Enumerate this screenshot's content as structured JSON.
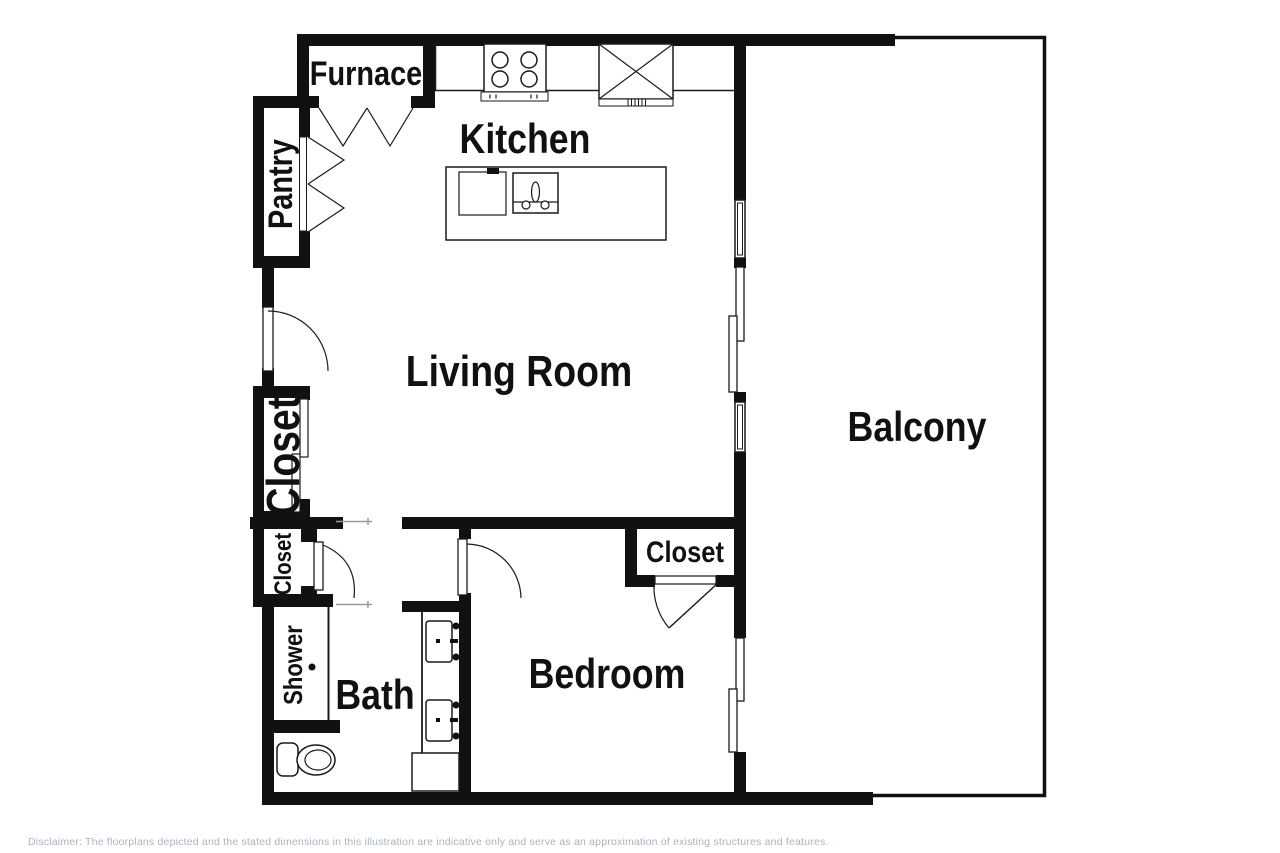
{
  "floorplan": {
    "rooms": {
      "furnace": {
        "label": "Furnace"
      },
      "kitchen": {
        "label": "Kitchen"
      },
      "pantry": {
        "label": "Pantry"
      },
      "living_room": {
        "label": "Living Room"
      },
      "closet_hall_large": {
        "label": "Closet"
      },
      "closet_hall_small": {
        "label": "Closet"
      },
      "closet_bedroom": {
        "label": "Closet"
      },
      "shower": {
        "label": "Shower"
      },
      "bath": {
        "label": "Bath"
      },
      "bedroom": {
        "label": "Bedroom"
      },
      "balcony": {
        "label": "Balcony"
      }
    },
    "fixtures": [
      "stove-4-burner",
      "range-hood-fan",
      "kitchen-island-with-sink",
      "entry-door-swing",
      "pantry-bifold-doors",
      "furnace-bifold-doors",
      "sliding-closet-doors",
      "double-vanity-sinks",
      "toilet",
      "shower-stall",
      "balcony-sliding-doors",
      "windows"
    ],
    "colors": {
      "wall": "#111111",
      "background": "#ffffff",
      "fixture_line": "#1a1a1a",
      "rod_line": "#999999",
      "disclaimer_text": "#a9b3c2"
    }
  },
  "footer": {
    "disclaimer": "Disclaimer: The floorplans depicted and the stated dimensions in this illustration are indicative only and serve as an approximation of existing structures and features."
  }
}
